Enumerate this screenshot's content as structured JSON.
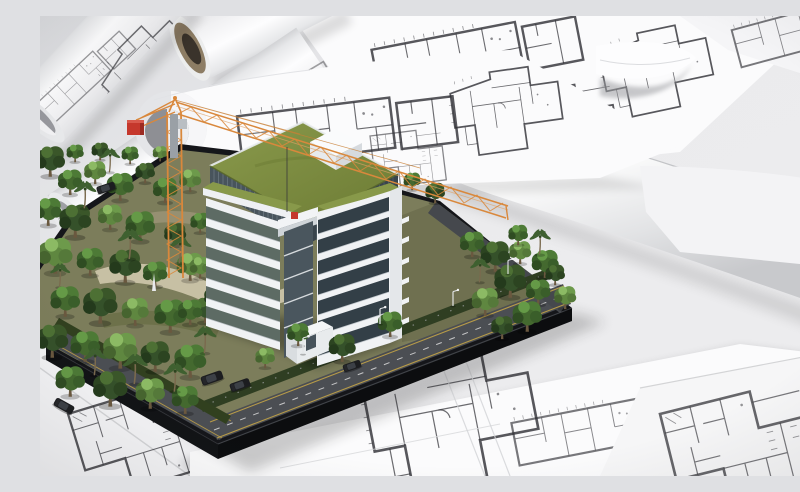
{
  "meta": {
    "domain": "natural-image",
    "description": "3D rendering of an architectural scale model: a white multi-storey building with planted green roofs and an orange tower crane, surrounded by miniature trees, roads and cars on a dark base, placed on top of white rolled and flat blueprint floor-plan sheets.",
    "canvas": {
      "width": 800,
      "height": 460
    }
  },
  "palette": {
    "bg": "#e9eaec",
    "paper": "#fbfbfc",
    "paper_shadow": "#c6c7ca",
    "plan_ink": "#2e2e33",
    "tube_core": "#8d7d64",
    "tube_hole": "#3a332b",
    "roof_green": "#7d8e41",
    "terrace_green": "#88994a",
    "glass_dark": "#48545c",
    "window_dark": "#333f47",
    "facade_white": "#f0f2f4",
    "facade_shadow": "#d9dde0",
    "crane_orange": "#d9883c",
    "crane_red": "#c5382c",
    "base_dark": "#15161a",
    "road": "#4b4e53",
    "road_line_yellow": "#c9a847",
    "grass": "#7c7d5b",
    "sand": "#cfc8ac",
    "tree_dark": "#2c4421",
    "tree_mid": "#3f6030",
    "tree_light": "#6d9a4b",
    "trunk": "#6a583f",
    "car_black": "#1c1d20"
  },
  "scene": {
    "model": {
      "building_floor_count": 7,
      "roof_type": "planted green roof with white penthouse volume",
      "crane": "orange lattice tower crane with red counterweight",
      "vehicle_count": 5,
      "base": "dark bevelled platform with perimeter roads and yellow lane lines"
    },
    "papers": {
      "rolled_blueprints": 5,
      "flat_sheets_with_floor_plans": 6,
      "tube_with_cardboard_core": 1
    },
    "objects": [
      "architectural-building-model",
      "tower-crane",
      "model-trees-and-palms",
      "model-cars",
      "street-lights",
      "blueprint-rolls",
      "floor-plan-sheets",
      "blueprint-tube-core"
    ]
  }
}
